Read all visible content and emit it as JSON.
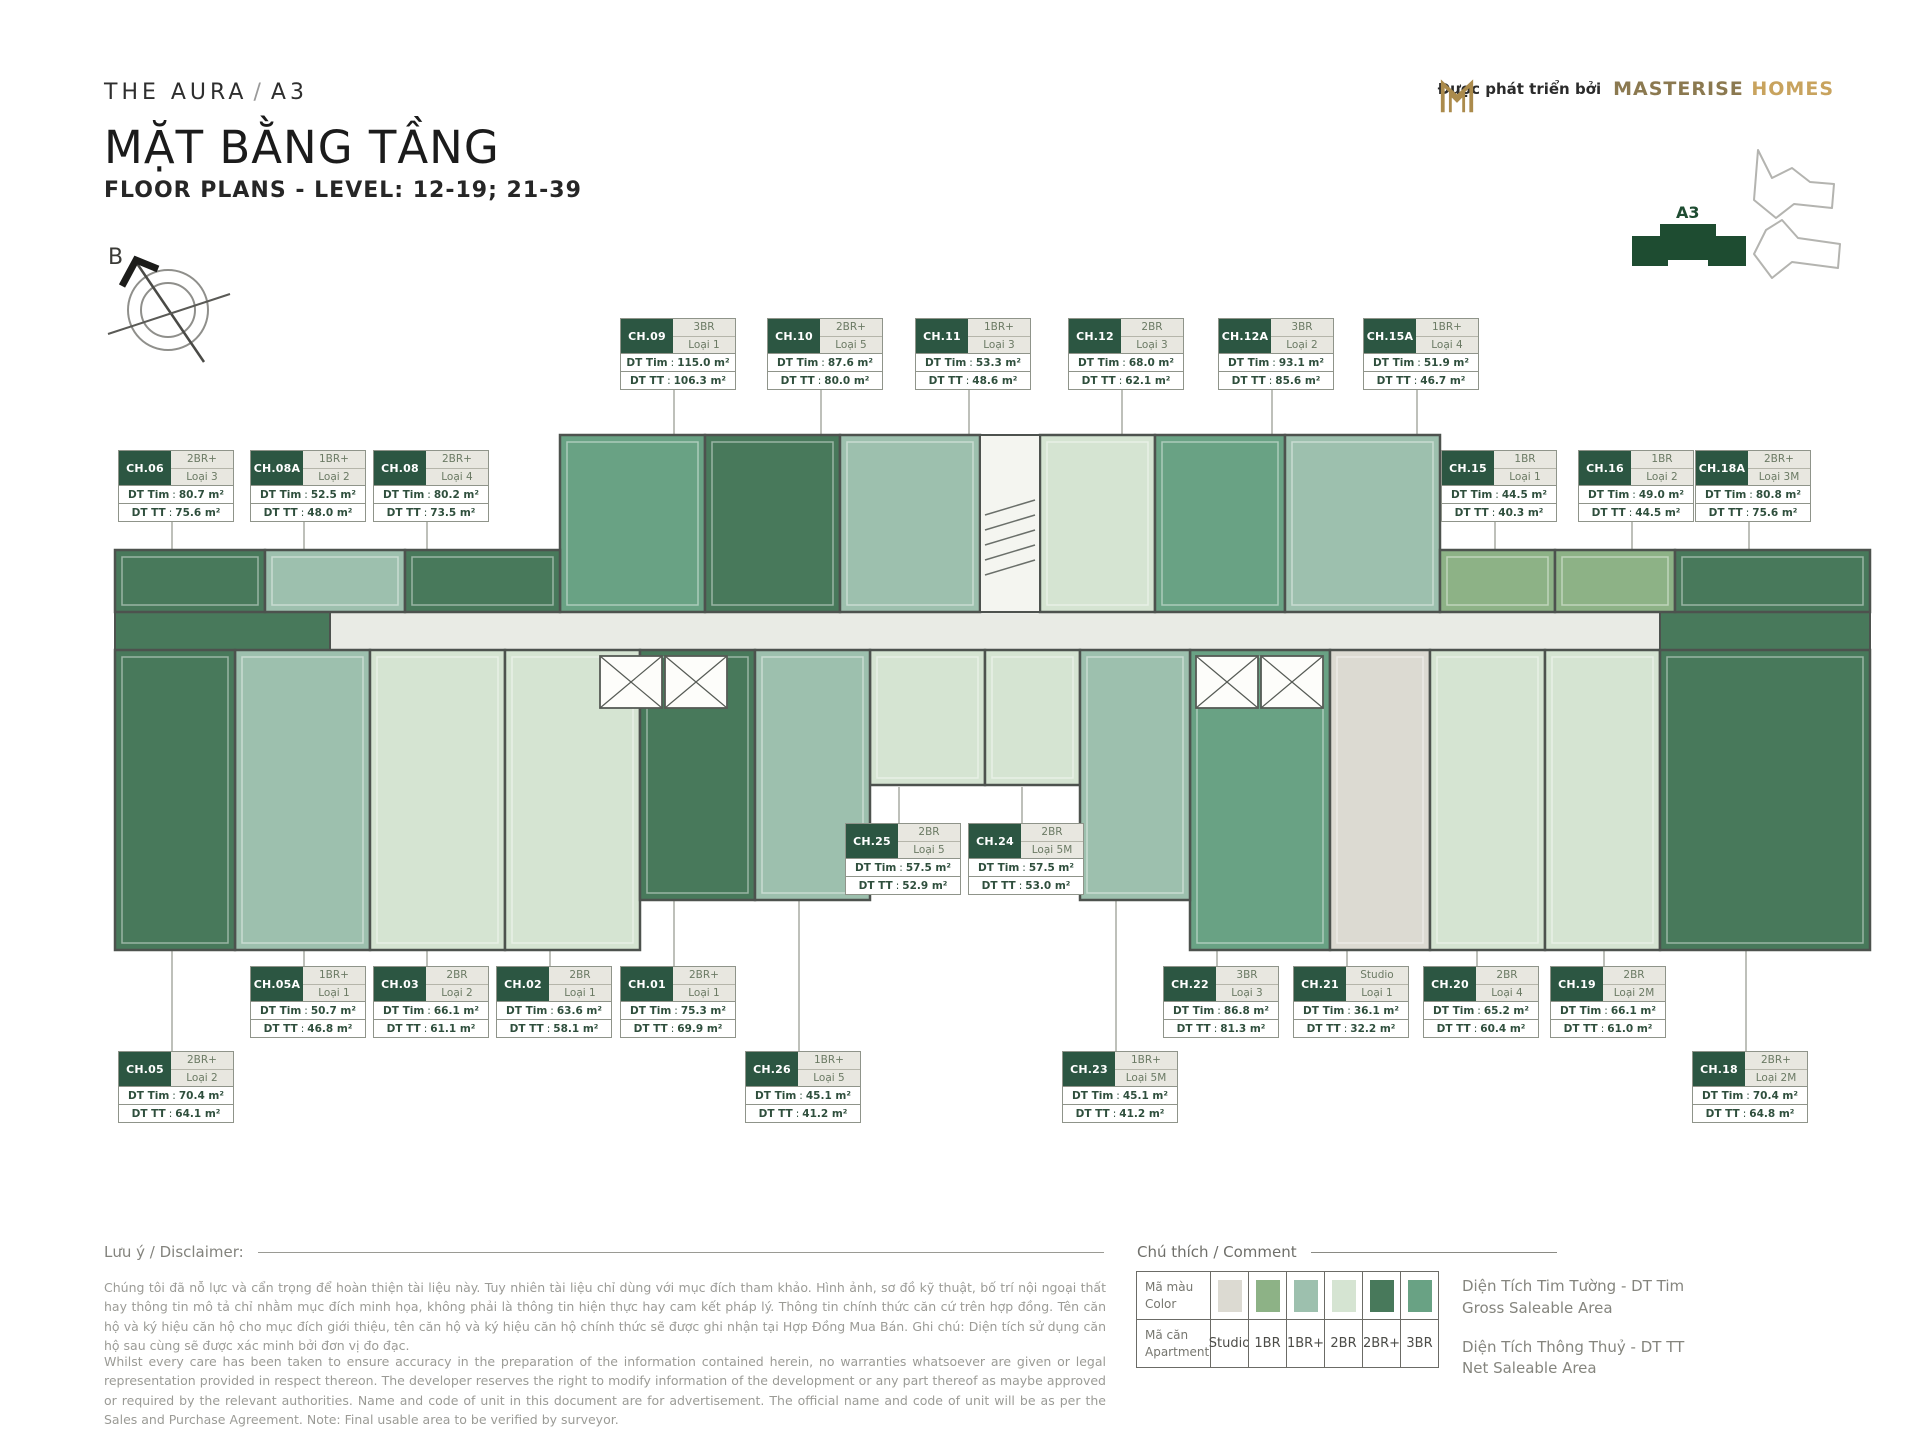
{
  "header": {
    "project": "THE AURA",
    "separator": "/",
    "block": "A3",
    "title_vi": "MẶT BẰNG TẦNG",
    "title_en": "FLOOR PLANS - LEVEL: 12-19; 21-39",
    "developer_prefix": "Được phát triển bởi",
    "developer_name_1": "MASTERISE",
    "developer_name_2": "HOMES"
  },
  "compass": {
    "north_label": "B"
  },
  "locator": {
    "active_block_label": "A3"
  },
  "card_labels": {
    "dt_tim": "DT Tim",
    "dt_tt": "DT TT"
  },
  "units": [
    {
      "id": "CH.09",
      "type": "3BR",
      "loai": "Loại 1",
      "dt_tim": "115.0 m²",
      "dt_tt": "106.3 m²"
    },
    {
      "id": "CH.10",
      "type": "2BR+",
      "loai": "Loại 5",
      "dt_tim": "87.6 m²",
      "dt_tt": "80.0 m²"
    },
    {
      "id": "CH.11",
      "type": "1BR+",
      "loai": "Loại 3",
      "dt_tim": "53.3 m²",
      "dt_tt": "48.6 m²"
    },
    {
      "id": "CH.12",
      "type": "2BR",
      "loai": "Loại 3",
      "dt_tim": "68.0 m²",
      "dt_tt": "62.1 m²"
    },
    {
      "id": "CH.12A",
      "type": "3BR",
      "loai": "Loại 2",
      "dt_tim": "93.1 m²",
      "dt_tt": "85.6 m²"
    },
    {
      "id": "CH.15A",
      "type": "1BR+",
      "loai": "Loại 4",
      "dt_tim": "51.9 m²",
      "dt_tt": "46.7 m²"
    },
    {
      "id": "CH.06",
      "type": "2BR+",
      "loai": "Loại 3",
      "dt_tim": "80.7 m²",
      "dt_tt": "75.6 m²"
    },
    {
      "id": "CH.08A",
      "type": "1BR+",
      "loai": "Loại 2",
      "dt_tim": "52.5 m²",
      "dt_tt": "48.0 m²"
    },
    {
      "id": "CH.08",
      "type": "2BR+",
      "loai": "Loại 4",
      "dt_tim": "80.2 m²",
      "dt_tt": "73.5 m²"
    },
    {
      "id": "CH.15",
      "type": "1BR",
      "loai": "Loại 1",
      "dt_tim": "44.5 m²",
      "dt_tt": "40.3 m²"
    },
    {
      "id": "CH.16",
      "type": "1BR",
      "loai": "Loại 2",
      "dt_tim": "49.0 m²",
      "dt_tt": "44.5 m²"
    },
    {
      "id": "CH.18A",
      "type": "2BR+",
      "loai": "Loại 3M",
      "dt_tim": "80.8 m²",
      "dt_tt": "75.6 m²"
    },
    {
      "id": "CH.25",
      "type": "2BR",
      "loai": "Loại 5",
      "dt_tim": "57.5 m²",
      "dt_tt": "52.9 m²"
    },
    {
      "id": "CH.24",
      "type": "2BR",
      "loai": "Loại 5M",
      "dt_tim": "57.5 m²",
      "dt_tt": "53.0 m²"
    },
    {
      "id": "CH.05A",
      "type": "1BR+",
      "loai": "Loại 1",
      "dt_tim": "50.7 m²",
      "dt_tt": "46.8 m²"
    },
    {
      "id": "CH.03",
      "type": "2BR",
      "loai": "Loại 2",
      "dt_tim": "66.1 m²",
      "dt_tt": "61.1 m²"
    },
    {
      "id": "CH.02",
      "type": "2BR",
      "loai": "Loại 1",
      "dt_tim": "63.6 m²",
      "dt_tt": "58.1 m²"
    },
    {
      "id": "CH.01",
      "type": "2BR+",
      "loai": "Loại 1",
      "dt_tim": "75.3 m²",
      "dt_tt": "69.9 m²"
    },
    {
      "id": "CH.22",
      "type": "3BR",
      "loai": "Loại 3",
      "dt_tim": "86.8 m²",
      "dt_tt": "81.3 m²"
    },
    {
      "id": "CH.21",
      "type": "Studio",
      "loai": "Loại 1",
      "dt_tim": "36.1 m²",
      "dt_tt": "32.2 m²"
    },
    {
      "id": "CH.20",
      "type": "2BR",
      "loai": "Loại 4",
      "dt_tim": "65.2 m²",
      "dt_tt": "60.4 m²"
    },
    {
      "id": "CH.19",
      "type": "2BR",
      "loai": "Loại 2M",
      "dt_tim": "66.1 m²",
      "dt_tt": "61.0 m²"
    },
    {
      "id": "CH.05",
      "type": "2BR+",
      "loai": "Loại 2",
      "dt_tim": "70.4 m²",
      "dt_tt": "64.1 m²"
    },
    {
      "id": "CH.26",
      "type": "1BR+",
      "loai": "Loại 5",
      "dt_tim": "45.1 m²",
      "dt_tt": "41.2 m²"
    },
    {
      "id": "CH.23",
      "type": "1BR+",
      "loai": "Loại 5M",
      "dt_tim": "45.1 m²",
      "dt_tt": "41.2 m²"
    },
    {
      "id": "CH.18",
      "type": "2BR+",
      "loai": "Loại 2M",
      "dt_tim": "70.4 m²",
      "dt_tt": "64.8 m²"
    }
  ],
  "legend": {
    "title": "Chú thích / Comment",
    "color_row_label_vi": "Mã màu",
    "color_row_label_en": "Color",
    "apt_row_label_vi": "Mã căn",
    "apt_row_label_en": "Apartment",
    "types": [
      {
        "label": "Studio",
        "color": "#dcdad2"
      },
      {
        "label": "1BR",
        "color": "#8db286"
      },
      {
        "label": "1BR+",
        "color": "#9dc0ae"
      },
      {
        "label": "2BR",
        "color": "#d5e4d2"
      },
      {
        "label": "2BR+",
        "color": "#48795b"
      },
      {
        "label": "3BR",
        "color": "#69a284"
      }
    ],
    "notes": [
      {
        "vi": "Diện Tích Tim Tường - DT Tim",
        "en": "Gross Saleable Area"
      },
      {
        "vi": "Diện Tích Thông Thuỷ - DT TT",
        "en": "Net Saleable Area"
      }
    ]
  },
  "disclaimer": {
    "label": "Lưu ý / Disclaimer:",
    "paragraph_vi": "Chúng tôi đã nỗ lực và cẩn trọng để hoàn thiện tài liệu này. Tuy nhiên tài liệu chỉ dùng với mục đích tham khảo. Hình ảnh, sơ đồ kỹ thuật, bố trí nội ngoại thất hay thông tin mô tả chỉ nhằm mục đích minh họa, không phải là thông tin hiện thực hay cam kết pháp lý. Thông tin chính thức căn cứ trên hợp đồng. Tên căn hộ và ký hiệu căn hộ cho mục đích giới thiệu, tên căn hộ và ký hiệu căn hộ chính thức sẽ được ghi nhận tại Hợp Đồng Mua Bán. Ghi chú: Diện tích sử dụng căn hộ sau cùng sẽ được xác minh bởi đơn vị đo đạc.",
    "paragraph_en": "Whilst every care has been taken to ensure accuracy in the preparation of the information contained herein, no warranties whatsoever are given or legal representation provided in respect thereon. The developer reserves the right to modify information of the development or any part thereof as maybe approved or required by the relevant authorities. Name and code of unit in this document are for advertisement. The official name and code of unit will be as per the Sales and Purchase Agreement. Note: Final usable area to be verified by surveyor."
  }
}
